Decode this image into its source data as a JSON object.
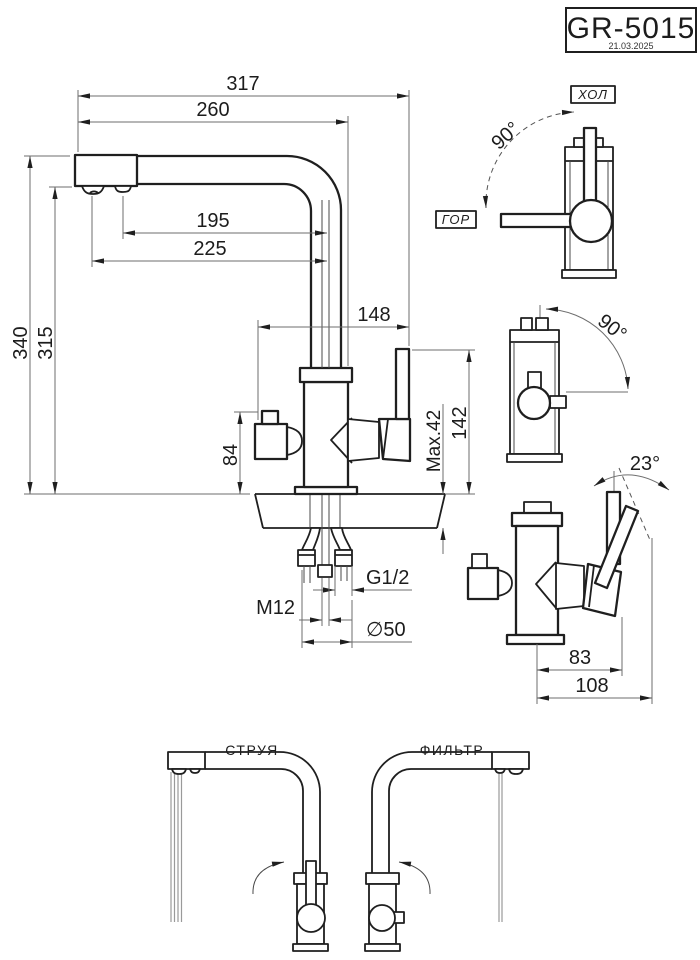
{
  "title_block": {
    "model": "GR-5015",
    "date": "21.03.2025"
  },
  "dims": {
    "overall": "317",
    "reach": "260",
    "outlet_stream": "195",
    "outlet_filter": "225",
    "body_span": "148",
    "height_total": "340",
    "height_outlet": "315",
    "valve_height": "84",
    "counter_max": "Max.42",
    "above_counter": "142",
    "hose_thread": "G1/2",
    "stud_thread": "M12",
    "hole_diameter": "∅50"
  },
  "views": {
    "top_rotation": {
      "cold": "ХОЛ",
      "hot": "ГОР",
      "angle": "90°"
    },
    "filter_rotation": {
      "angle": "90°"
    },
    "lever_tilt": {
      "angle": "23°",
      "to_lever": "83",
      "to_tip": "108"
    }
  },
  "bottom_views": {
    "stream": "СТРУЯ",
    "filter": "ФИЛЬТР"
  },
  "colors": {
    "line": "#1f1f1f",
    "dim_line": "#6e6e6e",
    "background": "#ffffff"
  }
}
